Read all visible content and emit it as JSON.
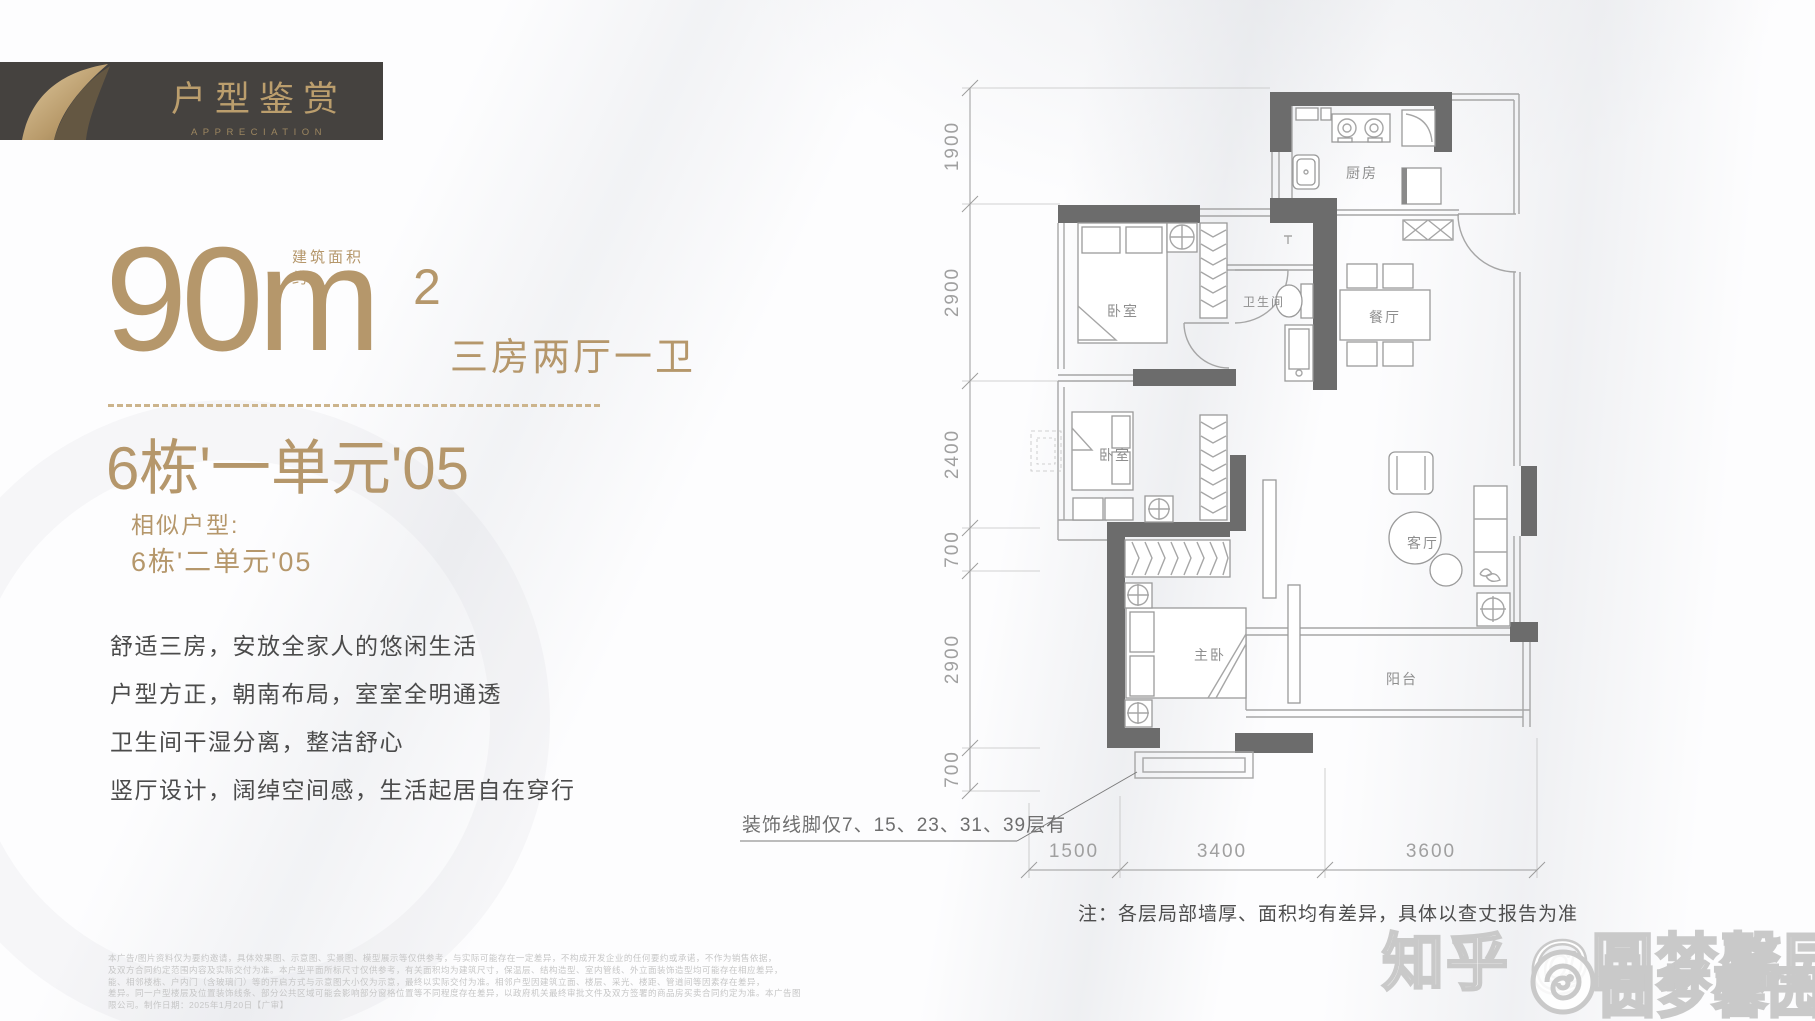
{
  "banner": {
    "title": "户型鉴赏",
    "subtitle": "APPRECIATION"
  },
  "headline": {
    "area_prefix": "建筑面积约",
    "area_value": "90m",
    "area_sup": "2",
    "area_suffix": "三房两厅一卫",
    "unit": "6栋'一单元'05",
    "similar_label": "相似户型:",
    "similar_value": "6栋'二单元'05"
  },
  "features": [
    "舒适三房，安放全家人的悠闲生活",
    "户型方正，朝南布局，室室全明通透",
    "卫生间干湿分离，整洁舒心",
    "竖厅设计，阔绰空间感，生活起居自在穿行"
  ],
  "floorplan": {
    "rooms": [
      "厨房",
      "卧室",
      "卫生间",
      "餐厅",
      "卧室",
      "客厅",
      "主卧",
      "阳台"
    ],
    "dims_vertical": [
      "1900",
      "2900",
      "2400",
      "700",
      "2900",
      "700"
    ],
    "dims_horizontal": [
      "1500",
      "3400",
      "3600"
    ],
    "note_decoration": "装饰线脚仅7、15、23、31、39层有",
    "note_bottom": "注：各层局部墙厚、面积均有差异，具体以查丈报告为准"
  },
  "watermark": {
    "main": "知乎 @圆梦馨园",
    "secondary": "圆梦馨园"
  },
  "disclaimer": {
    "lines": [
      "本广告/图片资料仅为要约邀请，具体效果图、示意图、实景图、模型展示等仅供参考，与实际可能存在一定差异，不构成开发企业的任何要约或承诺，不作为销售依据，",
      "及双方合同约定范围内容及实际交付为准。本户型平面所标尺寸仅供参考，有关面积均为建筑尺寸，保温层、结构造型、室内管线、外立面装饰造型均可能存在相应差异，",
      "能、相邻楼栋、户内门（含玻璃门）等的开启方式与示意图大小仅为示意，最终以实际交付为准。相邻户型因建筑立面、楼层、采光、楼距、管道间等因素存在差异，",
      "差异。同一户型楼层及位置装饰线条、部分公共区域可能会影响部分窗格位置等不同程度存在差异，以政府机关最终审批文件及双方签署的商品房买卖合同约定为准。本广告图",
      "限公司。制作日期：2025年1月20日【广审】"
    ]
  },
  "colors": {
    "gold": "#b5976b",
    "banner_bg": "#45423f",
    "wall": "#6c6c6c"
  }
}
